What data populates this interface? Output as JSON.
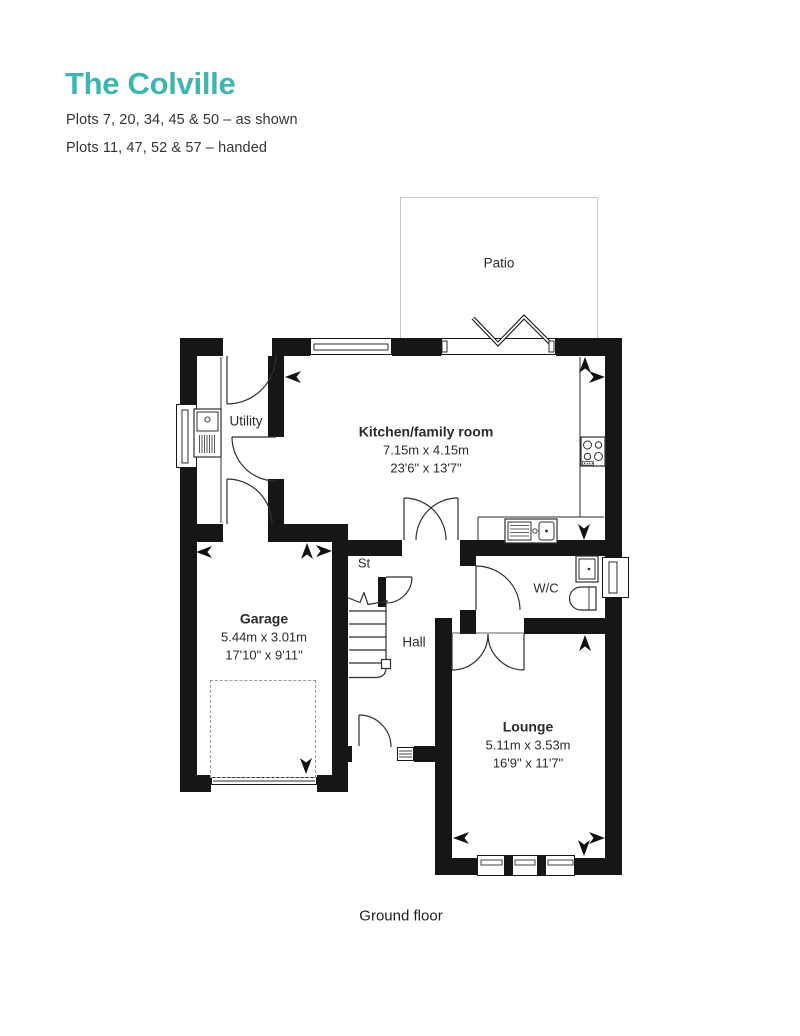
{
  "header": {
    "title": "The Colville",
    "plots_as_shown": "Plots 7, 20, 34, 45 & 50 – as shown",
    "plots_handed": "Plots 11, 47, 52 & 57 – handed",
    "accent_color": "#3db5b0"
  },
  "plan": {
    "caption": "Ground floor",
    "rooms": {
      "patio": {
        "name": "Patio"
      },
      "utility": {
        "name": "Utility"
      },
      "kitchen": {
        "name": "Kitchen/family room",
        "metric": "7.15m x 4.15m",
        "imperial": "23'6\" x 13'7\""
      },
      "st": {
        "name": "St"
      },
      "hall": {
        "name": "Hall"
      },
      "wc": {
        "name": "W/C"
      },
      "garage": {
        "name": "Garage",
        "metric": "5.44m x 3.01m",
        "imperial": "17'10\" x 9'11\""
      },
      "lounge": {
        "name": "Lounge",
        "metric": "5.11m x 3.53m",
        "imperial": "16'9\" x 11'7\""
      }
    }
  }
}
